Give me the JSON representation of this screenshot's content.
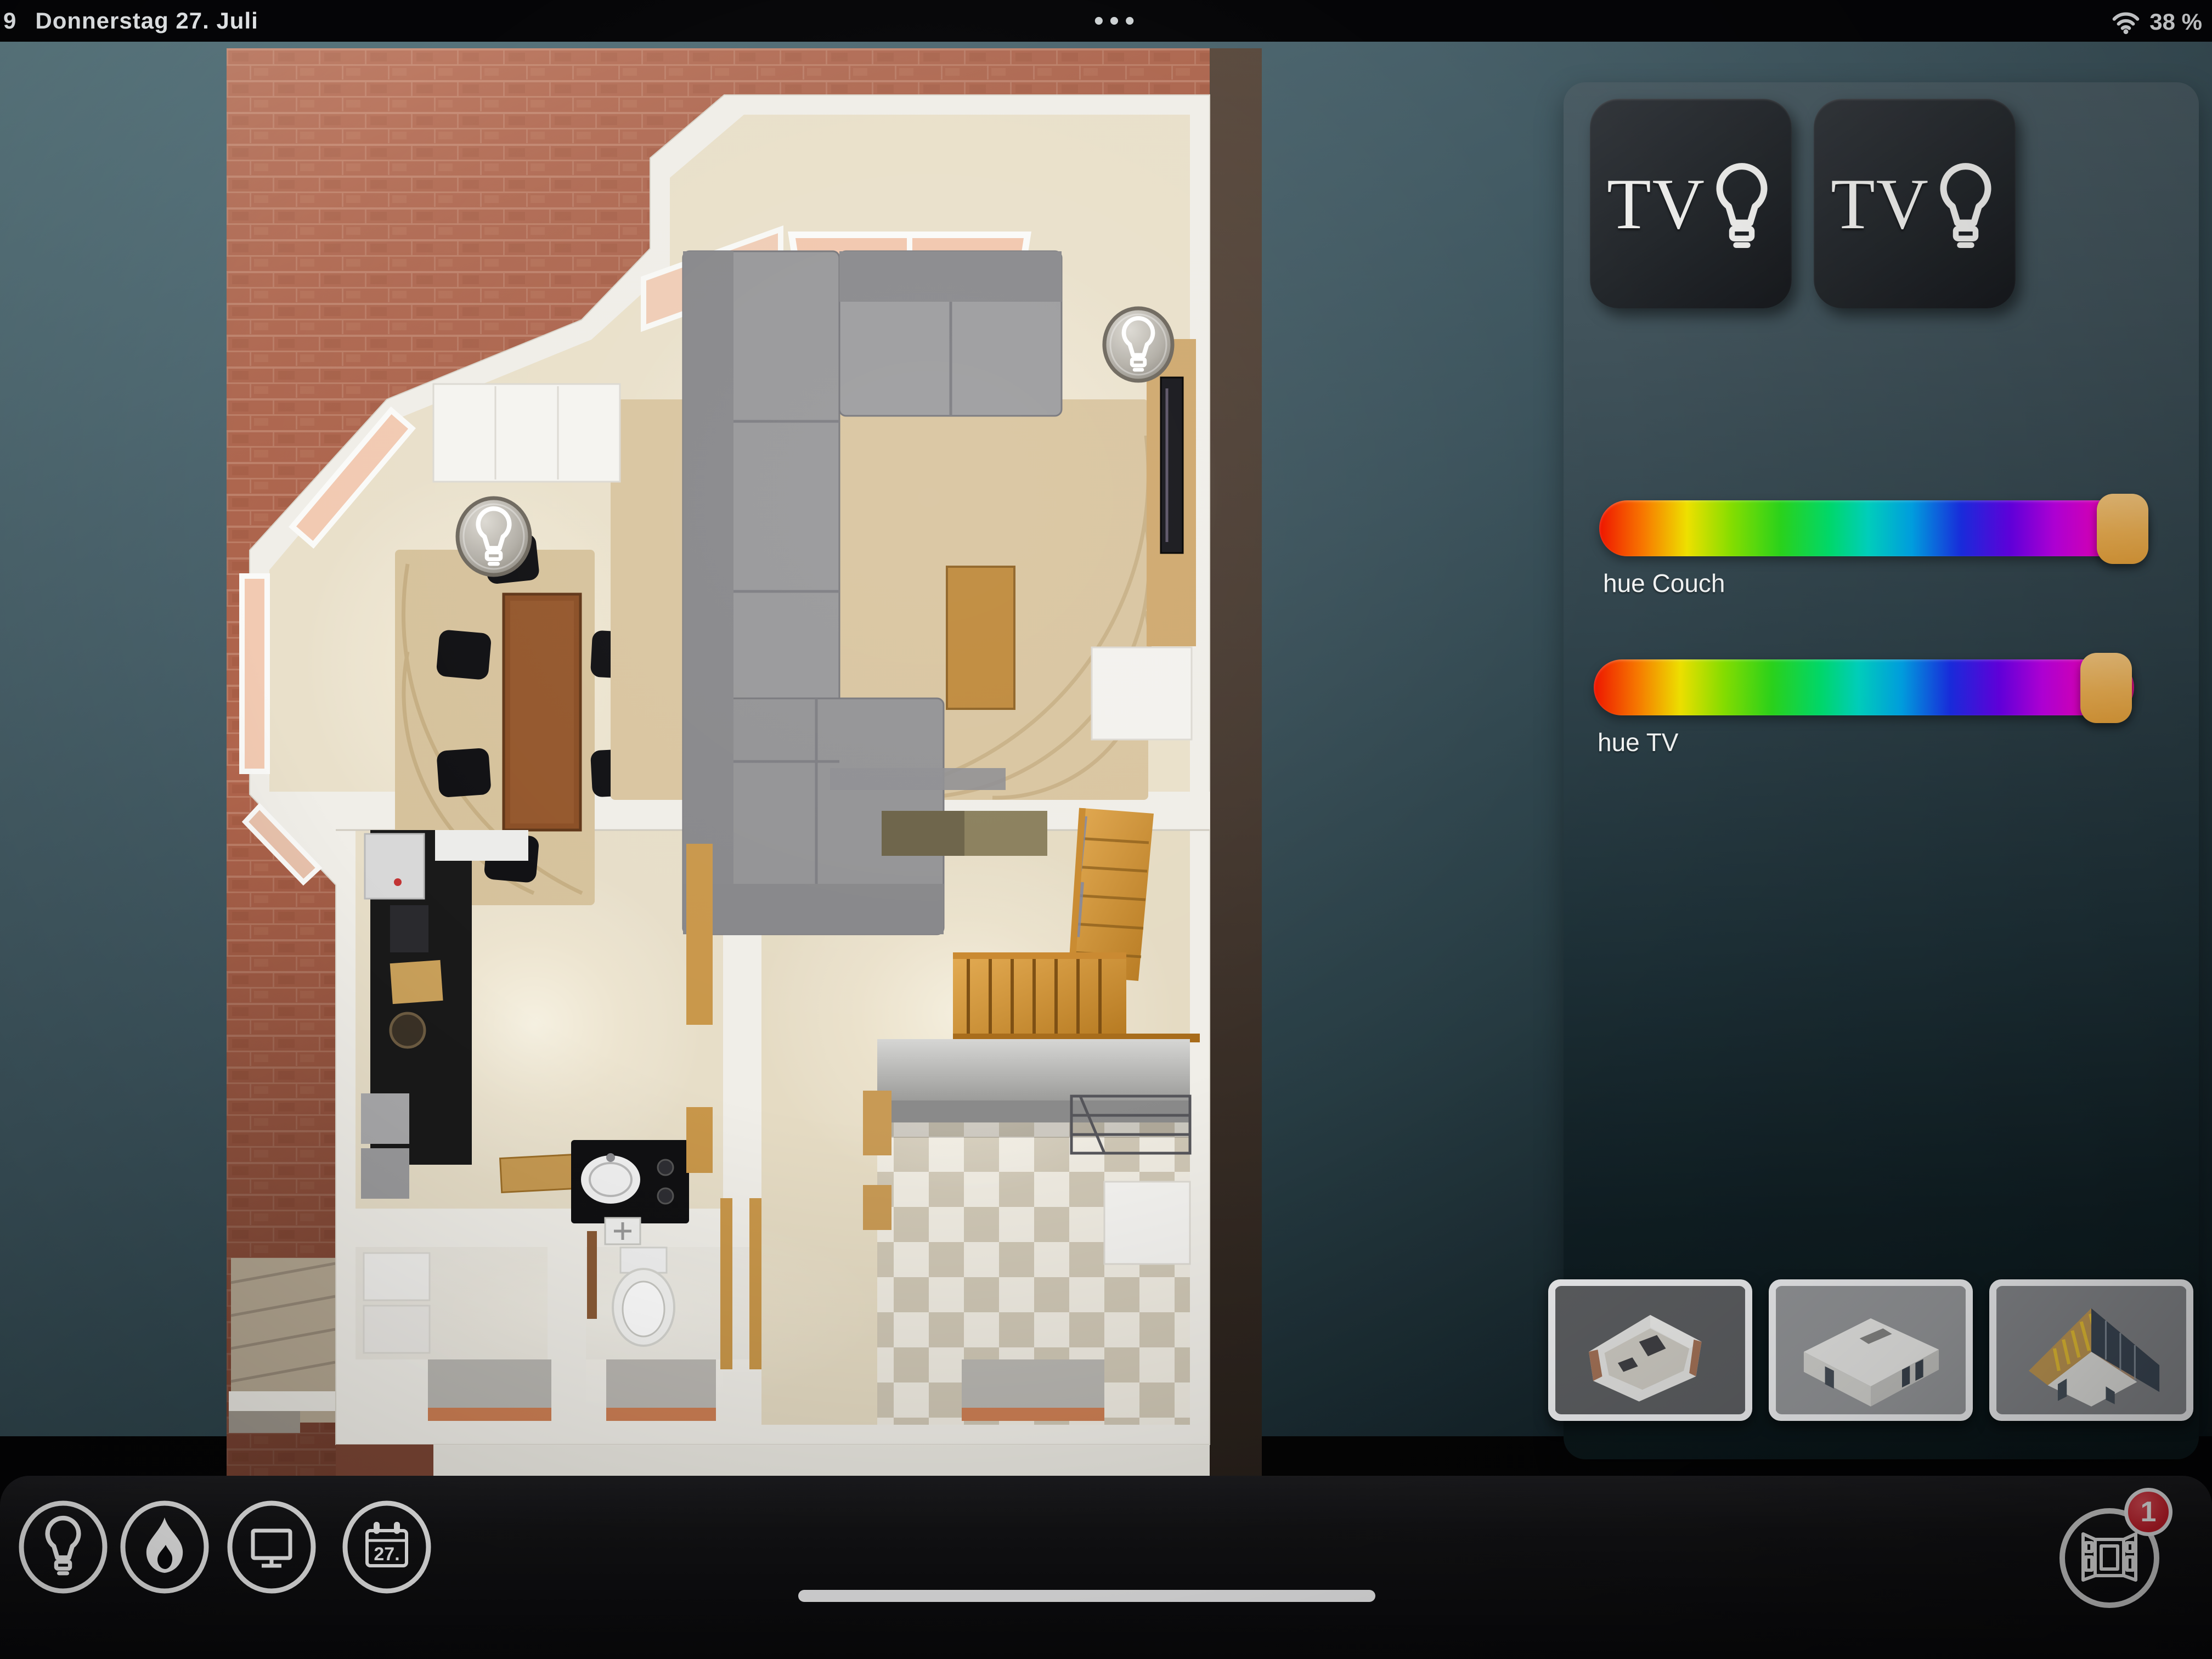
{
  "status_bar": {
    "time_partial": "9",
    "date": "Donnerstag 27. Juli",
    "multitask_dots": "•••",
    "wifi_icon": "wifi-icon",
    "battery_percent": "38 %"
  },
  "floorplan": {
    "view": "3d-floorplan-ground-floor",
    "light_buttons": [
      {
        "icon": "lightbulb-icon",
        "location": "dining-table"
      },
      {
        "icon": "lightbulb-icon",
        "location": "tv-wall"
      }
    ]
  },
  "right_panel": {
    "scene_buttons": [
      {
        "label": "TV",
        "icon": "lightbulb-icon"
      },
      {
        "label": "TV",
        "icon": "lightbulb-icon"
      }
    ],
    "sliders": [
      {
        "label": "hue Couch",
        "type": "hue-gradient",
        "handle_position": "right",
        "handle_color": "#f0b253"
      },
      {
        "label": "hue TV",
        "type": "hue-gradient",
        "handle_position": "right",
        "handle_color": "#f0b253"
      }
    ],
    "floor_thumbnails": [
      {
        "icon": "floor-thumbnail-walls"
      },
      {
        "icon": "floor-thumbnail-roofed"
      },
      {
        "icon": "floor-thumbnail-attic"
      }
    ]
  },
  "toolbar": {
    "items": [
      {
        "icon": "lightbulb-icon"
      },
      {
        "icon": "flame-icon"
      },
      {
        "icon": "monitor-icon"
      },
      {
        "icon": "calendar-icon",
        "day_label": "27."
      }
    ],
    "window_button": {
      "icon": "open-window-icon",
      "badge_count": "1"
    }
  },
  "colors": {
    "background_teal": "#4c656e",
    "panel_teal": "#30434b",
    "brick_red": "#b4674e",
    "slider_handle_orange": "#f0b253",
    "badge_red": "#cf1f2c",
    "toolbar_black": "#08080a"
  }
}
